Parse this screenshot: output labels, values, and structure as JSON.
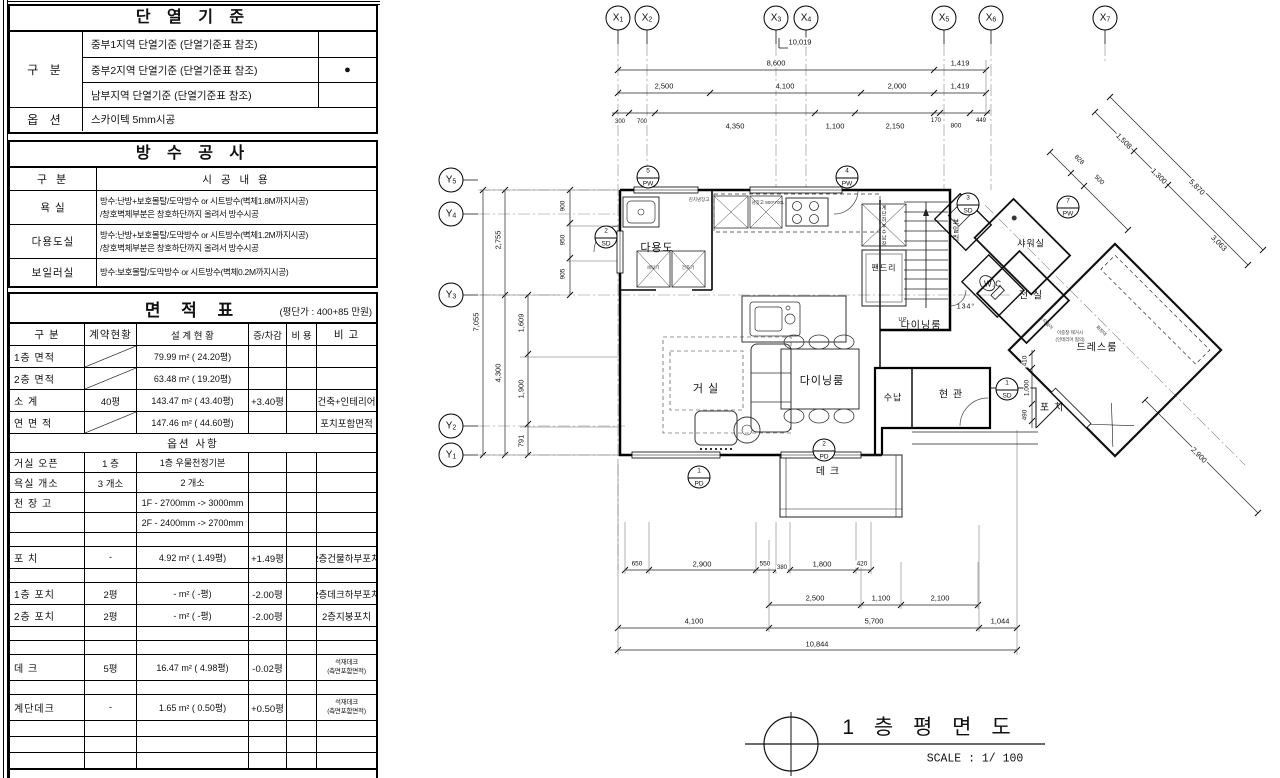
{
  "colors": {
    "ink": "#111111",
    "paper": "#ffffff",
    "grid": "#888888"
  },
  "insulation_table": {
    "title": "단 열 기 준",
    "col_label": "구 분",
    "rows": [
      {
        "text": "중부1지역 단열기준 (단열기준표 참조)",
        "mark": ""
      },
      {
        "text": "중부2지역 단열기준 (단열기준표 참조)",
        "mark": "●"
      },
      {
        "text": "남부지역 단열기준  (단열기준표 참조)",
        "mark": ""
      }
    ],
    "option_label": "옵 션",
    "option_text": "스카이텍 5mm시공"
  },
  "waterproof_table": {
    "title": "방 수 공 사",
    "header": {
      "col1": "구 분",
      "col2": "시 공 내 용"
    },
    "rows": [
      {
        "label": "욕    실",
        "line1": "방수:난방+보호몰탈/도막방수 or 시트방수(벽체1.8M까지시공)",
        "line2": "/창호벽체부분은 창호하단까지 올려서 방수시공"
      },
      {
        "label": "다용도실",
        "line1": "방수:난방+보호몰탈/도막방수 or 시트방수(벽체1.2M까지시공)",
        "line2": "/창호벽체부분은 창호하단까지 올려서 방수시공"
      },
      {
        "label": "보일러실",
        "line1": "방수:보호몰탈/도막방수 or 시트방수(벽체0.2M까지시공)",
        "line2": ""
      }
    ]
  },
  "area_table": {
    "title": "면 적 표",
    "subtitle": "(평단가 : 400+85 만원)",
    "headers": [
      "구  분",
      "계약현황",
      "설 계 현 황",
      "증/차감",
      "비 용",
      "비 고"
    ],
    "rows": [
      {
        "h": 21,
        "diag": true,
        "c": [
          "1층 면적",
          "",
          "79.99 m² ( 24.20평)",
          "",
          "",
          ""
        ]
      },
      {
        "h": 21,
        "diag": true,
        "c": [
          "2층 면적",
          "",
          "63.48 m² ( 19.20평)",
          "",
          "",
          ""
        ]
      },
      {
        "h": 21,
        "c": [
          "소    계",
          "40평",
          "143.47 m² ( 43.40평)",
          "+3.40평",
          "",
          "건축+인테리어"
        ]
      },
      {
        "h": 21,
        "diag": true,
        "c": [
          "연 면 적",
          "",
          "147.46 m² ( 44.60평)",
          "",
          "",
          "포치포함면적"
        ]
      },
      {
        "h": 18,
        "sub": "옵션 사항"
      },
      {
        "h": 19,
        "c": [
          "거실 오픈",
          "1 층",
          "1층 우물천정기본",
          "",
          "",
          ""
        ]
      },
      {
        "h": 19,
        "c": [
          "욕실 개소",
          "3 개소",
          "2 개소",
          "",
          "",
          ""
        ]
      },
      {
        "h": 19,
        "c": [
          "천 장 고",
          "",
          "1F - 2700mm -> 3000mm",
          "",
          "",
          ""
        ]
      },
      {
        "h": 19,
        "c": [
          "",
          "",
          "2F - 2400mm -> 2700mm",
          "",
          "",
          ""
        ]
      },
      {
        "h": 13,
        "c": [
          "",
          "",
          "",
          "",
          "",
          ""
        ]
      },
      {
        "h": 21,
        "c": [
          "포    치",
          "-",
          "4.92 m² (  1.49평)",
          "+1.49평",
          "",
          "2층건물하부포치"
        ]
      },
      {
        "h": 13,
        "c": [
          "",
          "",
          "",
          "",
          "",
          ""
        ]
      },
      {
        "h": 21,
        "c": [
          "1층 포치",
          "2평",
          "- m² (     -평)",
          "-2.00평",
          "",
          "2층데크하부포치"
        ]
      },
      {
        "h": 21,
        "c": [
          "2층 포치",
          "2평",
          "- m² (     -평)",
          "-2.00평",
          "",
          "2층지붕포치"
        ]
      },
      {
        "h": 13,
        "c": [
          "",
          "",
          "",
          "",
          "",
          ""
        ]
      },
      {
        "h": 13,
        "c": [
          "",
          "",
          "",
          "",
          "",
          ""
        ]
      },
      {
        "h": 25,
        "small": true,
        "c": [
          "데    크",
          "5평",
          "16.47 m² (  4.98평)",
          "-0.02평",
          "",
          "석재데크|(측면포함면적)"
        ]
      },
      {
        "h": 13,
        "c": [
          "",
          "",
          "",
          "",
          "",
          ""
        ]
      },
      {
        "h": 25,
        "small": true,
        "c": [
          "계단데크",
          "-",
          "1.65 m² (  0.50평)",
          "+0.50평",
          "",
          "석재데크|(측면포함면적)"
        ]
      },
      {
        "h": 15,
        "c": [
          "",
          "",
          "",
          "",
          "",
          ""
        ]
      },
      {
        "h": 15,
        "c": [
          "",
          "",
          "",
          "",
          "",
          ""
        ]
      },
      {
        "h": 15,
        "c": [
          "",
          "",
          "",
          "",
          "",
          ""
        ]
      },
      {
        "h": 15,
        "c": [
          "",
          "",
          "",
          "",
          "",
          ""
        ]
      }
    ]
  },
  "plan": {
    "title": "1 층 평 면 도",
    "scale_label": "SCALE : 1/ 100",
    "grid_bubbles_x": [
      {
        "l": "X1",
        "x": 618
      },
      {
        "l": "X2",
        "x": 647
      },
      {
        "l": "X3",
        "x": 776
      },
      {
        "l": "X4",
        "x": 806
      },
      {
        "l": "X5",
        "x": 944
      },
      {
        "l": "X6",
        "x": 991
      },
      {
        "l": "X7",
        "x": 1105
      }
    ],
    "grid_bubbles_y": [
      {
        "l": "Y5",
        "y": 180
      },
      {
        "l": "Y4",
        "y": 214
      },
      {
        "l": "Y3",
        "y": 295
      },
      {
        "l": "Y2",
        "y": 426
      },
      {
        "l": "Y1",
        "y": 455
      }
    ],
    "tag_markers": [
      {
        "n": "5",
        "c": "PW",
        "x": 648,
        "y": 177
      },
      {
        "n": "4",
        "c": "PW",
        "x": 847,
        "y": 177
      },
      {
        "n": "3",
        "c": "SD",
        "x": 968,
        "y": 204
      },
      {
        "n": "7",
        "c": "PW",
        "x": 1068,
        "y": 207
      },
      {
        "n": "2",
        "c": "SD",
        "x": 606,
        "y": 237
      },
      {
        "n": "1",
        "c": "PD",
        "x": 699,
        "y": 477
      },
      {
        "n": "2",
        "c": "PD",
        "x": 824,
        "y": 450
      },
      {
        "n": "1",
        "c": "SD",
        "x": 1007,
        "y": 389
      }
    ],
    "room_labels": [
      {
        "t": "다용도",
        "x": 657,
        "y": 247,
        "s": 11
      },
      {
        "t": "팬드리",
        "x": 884,
        "y": 268,
        "s": 8
      },
      {
        "t": "계단하부수납장",
        "x": 884,
        "y": 226,
        "s": 5,
        "v": 1
      },
      {
        "t": "다이닝룸",
        "x": 921,
        "y": 324,
        "s": 10
      },
      {
        "t": "거 실",
        "x": 706,
        "y": 388,
        "s": 11
      },
      {
        "t": "다이닝룸",
        "x": 822,
        "y": 380,
        "s": 11
      },
      {
        "t": "수납",
        "x": 893,
        "y": 397,
        "s": 9
      },
      {
        "t": "현 관",
        "x": 951,
        "y": 393,
        "s": 10
      },
      {
        "t": "데 크",
        "x": 828,
        "y": 470,
        "s": 10
      },
      {
        "t": "포 치",
        "x": 1052,
        "y": 406,
        "s": 10
      },
      {
        "t": "샤워실",
        "x": 1031,
        "y": 243,
        "s": 9
      },
      {
        "t": "W.C",
        "x": 993,
        "y": 284,
        "s": 8
      },
      {
        "t": "전 실",
        "x": 1031,
        "y": 294,
        "s": 10
      },
      {
        "t": "드레스룸",
        "x": 1097,
        "y": 346,
        "s": 10
      },
      {
        "t": "보일러",
        "x": 955,
        "y": 230,
        "s": 7,
        "v": 1
      },
      {
        "t": "134°",
        "x": 966,
        "y": 307,
        "s": 7
      },
      {
        "t": "UP",
        "x": 903,
        "y": 320,
        "s": 5
      },
      {
        "t": "김치냉장고",
        "x": 699,
        "y": 200,
        "s": 4.5,
        "c": 1
      },
      {
        "t": "냉장고 800*700L",
        "x": 768,
        "y": 203,
        "s": 4.5,
        "c": 1
      },
      {
        "t": "세탁기",
        "x": 653,
        "y": 268,
        "s": 4.5,
        "c": 1
      },
      {
        "t": "건조기",
        "x": 688,
        "y": 268,
        "s": 4.5,
        "c": 1
      },
      {
        "t": "스타일러",
        "x": 1046,
        "y": 323,
        "s": 4.5,
        "r": 45,
        "c": 1
      },
      {
        "t": "화장대",
        "x": 1101,
        "y": 331,
        "s": 4.5,
        "r": 45,
        "c": 1
      },
      {
        "t": "이중창 제거시",
        "x": 1070,
        "y": 333,
        "s": 4.5,
        "c": 1
      },
      {
        "t": "(인테리어 협의)",
        "x": 1070,
        "y": 340,
        "s": 4.5,
        "c": 1
      }
    ],
    "dim_labels": [
      {
        "t": "10,019",
        "x": 800,
        "y": 42
      },
      {
        "t": "8,600",
        "x": 776,
        "y": 63
      },
      {
        "t": "1,419",
        "x": 960,
        "y": 63
      },
      {
        "t": "2,500",
        "x": 664,
        "y": 86
      },
      {
        "t": "4,100",
        "x": 785,
        "y": 86
      },
      {
        "t": "2,000",
        "x": 897,
        "y": 86
      },
      {
        "t": "1,419",
        "x": 960,
        "y": 86
      },
      {
        "t": "300",
        "x": 620,
        "y": 122,
        "s": 6
      },
      {
        "t": "700",
        "x": 642,
        "y": 122,
        "s": 6
      },
      {
        "t": "4,350",
        "x": 735,
        "y": 126
      },
      {
        "t": "1,100",
        "x": 835,
        "y": 126
      },
      {
        "t": "2,150",
        "x": 895,
        "y": 126
      },
      {
        "t": "170",
        "x": 936,
        "y": 121,
        "s": 6
      },
      {
        "t": "800",
        "x": 956,
        "y": 126,
        "s": 6.5
      },
      {
        "t": "449",
        "x": 981,
        "y": 121,
        "s": 6
      },
      {
        "t": "7,055",
        "x": 476,
        "y": 322,
        "r": -90
      },
      {
        "t": "2,755",
        "x": 498,
        "y": 240,
        "r": -90
      },
      {
        "t": "4,300",
        "x": 498,
        "y": 373,
        "r": -90
      },
      {
        "t": "1,609",
        "x": 521,
        "y": 323,
        "r": -90
      },
      {
        "t": "1,900",
        "x": 521,
        "y": 389,
        "r": -90
      },
      {
        "t": "791",
        "x": 521,
        "y": 441,
        "r": -90
      },
      {
        "t": "900",
        "x": 563,
        "y": 206,
        "r": -90,
        "s": 6.5
      },
      {
        "t": "950",
        "x": 563,
        "y": 240,
        "r": -90,
        "s": 6.5
      },
      {
        "t": "905",
        "x": 563,
        "y": 274,
        "r": -90,
        "s": 6.5
      },
      {
        "t": "410",
        "x": 1025,
        "y": 361,
        "r": -90,
        "s": 6.5
      },
      {
        "t": "1,000",
        "x": 1027,
        "y": 388,
        "r": -90,
        "s": 6.5
      },
      {
        "t": "490",
        "x": 1025,
        "y": 415,
        "r": -90,
        "s": 6.5
      },
      {
        "t": "828",
        "x": 1079,
        "y": 160,
        "r": 45,
        "s": 6.5
      },
      {
        "t": "500",
        "x": 1099,
        "y": 180,
        "r": 45,
        "s": 6.5
      },
      {
        "t": "1,508",
        "x": 1124,
        "y": 141,
        "r": 45
      },
      {
        "t": "1,300",
        "x": 1159,
        "y": 176,
        "r": 45
      },
      {
        "t": "5,870",
        "x": 1197,
        "y": 187,
        "r": 45
      },
      {
        "t": "3,063",
        "x": 1219,
        "y": 243,
        "r": 45
      },
      {
        "t": "2,900",
        "x": 1199,
        "y": 455,
        "r": 45
      },
      {
        "t": "650",
        "x": 637,
        "y": 564,
        "s": 6.5
      },
      {
        "t": "2,900",
        "x": 702,
        "y": 564
      },
      {
        "t": "550",
        "x": 765,
        "y": 564,
        "s": 6.5
      },
      {
        "t": "380",
        "x": 782,
        "y": 568,
        "s": 6
      },
      {
        "t": "1,800",
        "x": 822,
        "y": 564
      },
      {
        "t": "420",
        "x": 862,
        "y": 564,
        "s": 6.5
      },
      {
        "t": "2,500",
        "x": 815,
        "y": 598
      },
      {
        "t": "1,100",
        "x": 881,
        "y": 598
      },
      {
        "t": "2,100",
        "x": 940,
        "y": 598
      },
      {
        "t": "4,100",
        "x": 694,
        "y": 621
      },
      {
        "t": "5,700",
        "x": 874,
        "y": 621
      },
      {
        "t": "1,044",
        "x": 1000,
        "y": 621
      },
      {
        "t": "10,844",
        "x": 817,
        "y": 644
      }
    ]
  }
}
